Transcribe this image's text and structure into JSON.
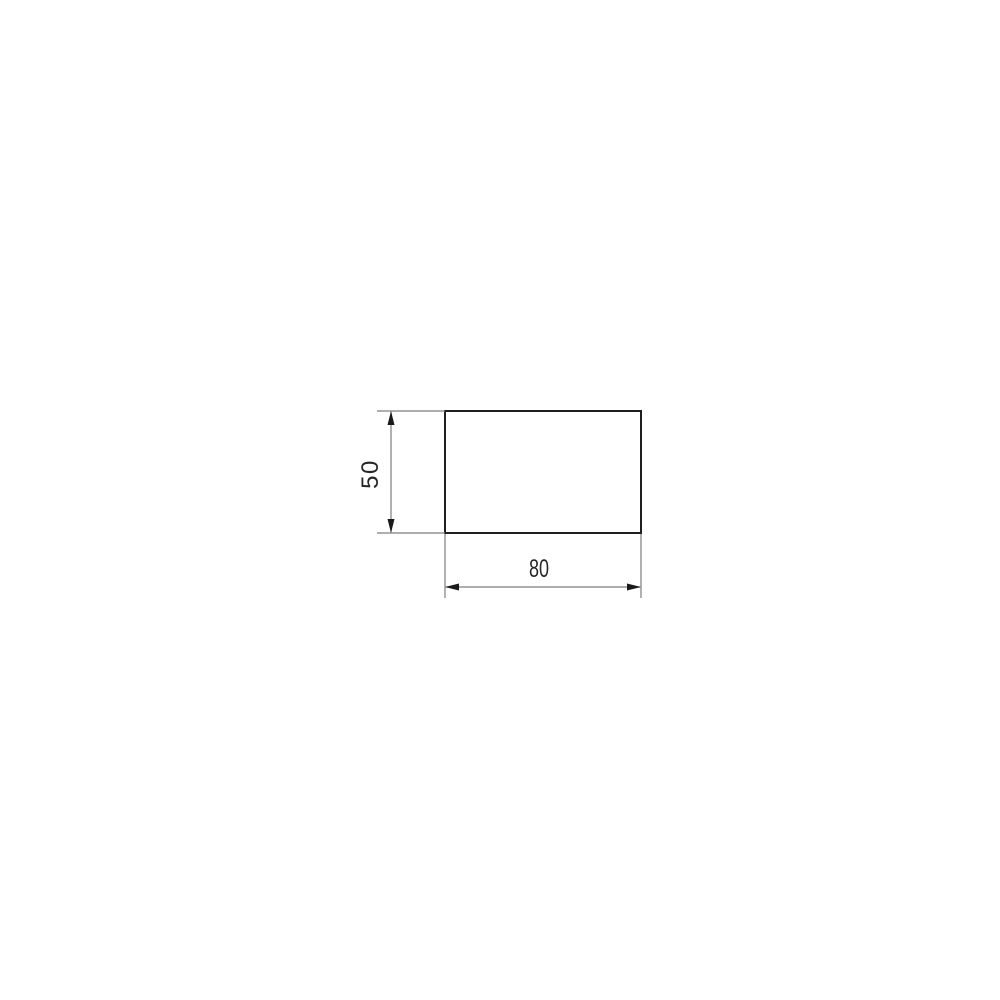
{
  "figure": {
    "type": "dimensioned-rectangle-drawing",
    "width_dim_label": "80",
    "height_dim_label": "50",
    "dimensions": {
      "width": 80,
      "height": 50
    },
    "colors": {
      "background": "#ffffff",
      "outline": "#1f1f1f",
      "dimension_line": "#7d7d7d",
      "arrow": "#1a1a1a",
      "text": "#262626"
    }
  }
}
